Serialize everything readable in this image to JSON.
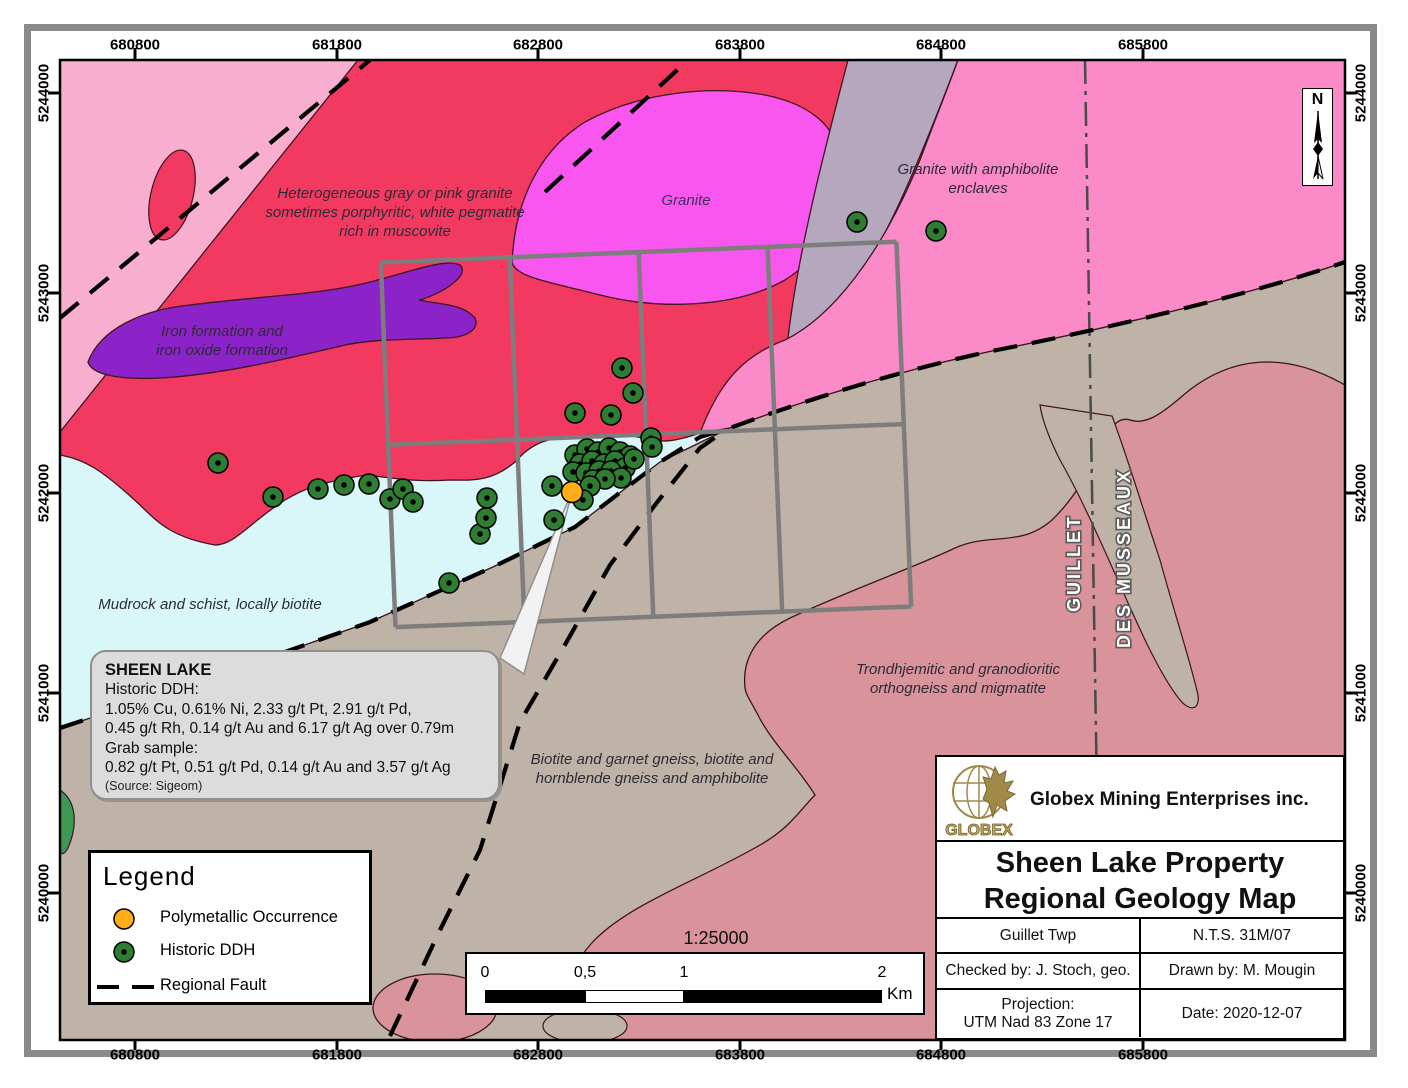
{
  "axes": {
    "x_labels": [
      "680800",
      "681800",
      "682800",
      "683800",
      "684800",
      "685800"
    ],
    "y_labels": [
      "5244000",
      "5243000",
      "5242000",
      "5241000",
      "5240000"
    ]
  },
  "map": {
    "north": "N",
    "labels": {
      "heterogeneous": [
        "Heterogeneous gray or pink granite",
        "sometimes porphyritic, white pegmatite",
        "rich in muscovite"
      ],
      "granite": "Granite",
      "granite_amphibolite": [
        "Granite with amphibolite",
        "enclaves"
      ],
      "iron": [
        "Iron formation and",
        "iron oxide formation"
      ],
      "mudrock": "Mudrock and schist, locally biotite",
      "trondhjemitic": [
        "Trondhjemitic and granodioritic",
        "orthogneiss and migmatite"
      ],
      "biotite_gneiss": [
        "Biotite and garnet gneiss, biotite and",
        "hornblende gneiss and amphibolite"
      ],
      "township_left": "GUILLET",
      "township_right": "DES MUSSEAUX"
    },
    "ddh_points": [
      [
        857,
        222
      ],
      [
        936,
        231
      ],
      [
        218,
        463
      ],
      [
        273,
        497
      ],
      [
        318,
        489
      ],
      [
        344,
        485
      ],
      [
        369,
        484
      ],
      [
        390,
        499
      ],
      [
        403,
        489
      ],
      [
        413,
        502
      ],
      [
        449,
        583
      ],
      [
        480,
        534
      ],
      [
        486,
        518
      ],
      [
        487,
        498
      ],
      [
        552,
        486
      ],
      [
        554,
        520
      ],
      [
        575,
        455
      ],
      [
        587,
        449
      ],
      [
        598,
        452
      ],
      [
        609,
        448
      ],
      [
        620,
        452
      ],
      [
        630,
        456
      ],
      [
        580,
        464
      ],
      [
        592,
        461
      ],
      [
        604,
        464
      ],
      [
        615,
        461
      ],
      [
        625,
        468
      ],
      [
        573,
        472
      ],
      [
        586,
        473
      ],
      [
        599,
        471
      ],
      [
        611,
        471
      ],
      [
        621,
        478
      ],
      [
        593,
        480
      ],
      [
        605,
        479
      ],
      [
        590,
        486
      ],
      [
        583,
        500
      ],
      [
        575,
        413
      ],
      [
        611,
        415
      ],
      [
        622,
        368
      ],
      [
        633,
        393
      ],
      [
        651,
        438
      ],
      [
        652,
        447
      ],
      [
        634,
        459
      ]
    ],
    "occurrence_point": [
      572,
      492
    ]
  },
  "callout": {
    "title": "SHEEN LAKE",
    "lines": [
      "Historic DDH:",
      "1.05% Cu, 0.61% Ni, 2.33 g/t Pt, 2.91 g/t Pd,",
      "0.45 g/t Rh, 0.14 g/t Au and 6.17 g/t Ag over 0.79m",
      "Grab sample:",
      "0.82 g/t Pt, 0.51 g/t Pd, 0.14 g/t Au and 3.57 g/t Ag"
    ],
    "source": "(Source: Sigeom)"
  },
  "legend": {
    "title": "Legend",
    "items": [
      {
        "symbol": "occurrence-dot",
        "label": "Polymetallic Occurrence"
      },
      {
        "symbol": "ddh-dot",
        "label": "Historic DDH"
      },
      {
        "symbol": "fault-line",
        "label": "Regional Fault"
      }
    ]
  },
  "scale_bar": {
    "ratio": "1:25000",
    "tick_labels": [
      "0",
      "0,5",
      "1",
      "2"
    ],
    "unit": "Km"
  },
  "title_block": {
    "company": "Globex Mining Enterprises inc.",
    "logo_text": "GLOBEX",
    "title_lines": [
      "Sheen Lake Property",
      "Regional Geology Map"
    ],
    "township": "Guillet Twp",
    "nts": "N.T.S. 31M/07",
    "checked_by": "Checked by: J. Stoch, geo.",
    "drawn_by": "Drawn by: M. Mougin",
    "projection_label": "Projection:",
    "projection_value": "UTM Nad 83 Zone 17",
    "date": "Date: 2020-12-07"
  },
  "colors": {
    "crimson_granite": "#F23A60",
    "light_pink": "#F8AECE",
    "magenta_granite": "#F956F0",
    "purple_iron": "#8C23C8",
    "gray_unit": "#B4A7BE",
    "hot_pink_granite": "#FB8AC8",
    "cyan_mudrock": "#D9F7F8",
    "tan_gneiss": "#BFB2A7",
    "rose_orthogneiss": "#D8939B",
    "green_unit": "#3C9A54",
    "ddh_green": "#2E7D32",
    "occurrence_orange": "#FFAE1A",
    "claim_grid_gray": "#7D7D7D"
  }
}
